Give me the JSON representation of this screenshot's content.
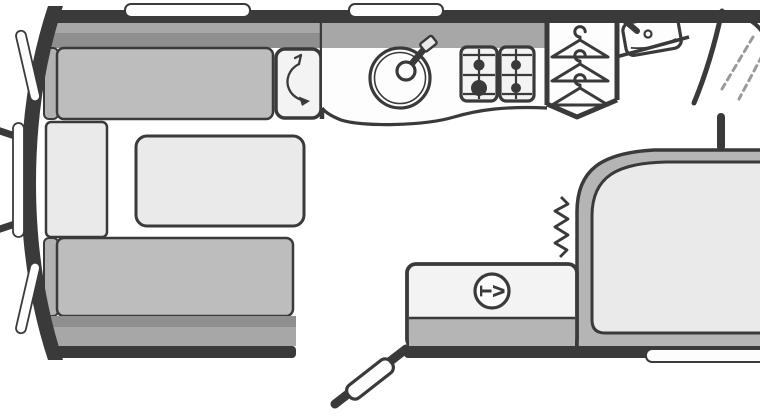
{
  "diagram": {
    "kind": "caravan-floorplan",
    "tv": {
      "label": "TV",
      "letters": [
        "T",
        "V"
      ]
    },
    "features": [
      "hitch-drawbar",
      "front-windows",
      "top-windows",
      "rear-window",
      "front-lounge-bench-top",
      "front-lounge-bench-bottom",
      "front-chest",
      "lounge-table",
      "swivel-locker",
      "kitchen-worktop",
      "sink-with-tap",
      "hob-4-burner",
      "wardrobe-3-hangers",
      "washbasin-with-tap",
      "shower-enclosure",
      "island-bed",
      "bedroom-curtain",
      "tv-cabinet",
      "tv-point",
      "entrance-door-open"
    ]
  },
  "colors": {
    "wall": "#3a3a3a",
    "band": "#a7a7a7",
    "band_dark": "#8f8f8f",
    "cushion": "#bdbdbd",
    "cushion_end": "#b2b2b2",
    "panel": "#eaeaea",
    "unit": "#f3f3f3",
    "white": "#fdfdfd",
    "frame": "#b5b5b5",
    "dash": "#9a9a9a",
    "background": "#ffffff"
  }
}
